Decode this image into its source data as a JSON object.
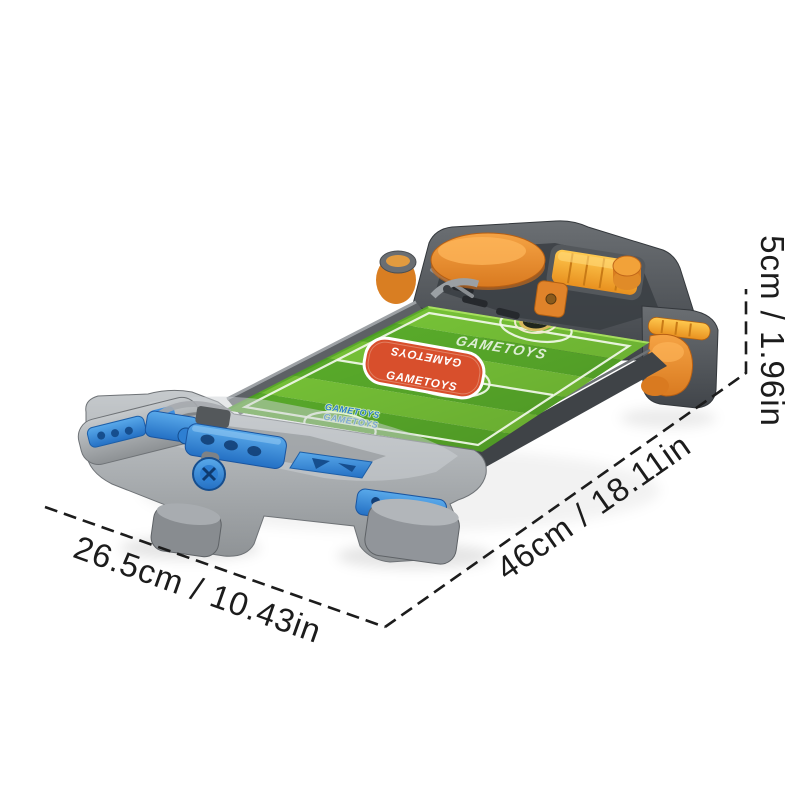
{
  "dimensions": {
    "depth": {
      "label": "26.5cm / 10.43in",
      "cm": 26.5,
      "in": 10.43
    },
    "length": {
      "label": "46cm / 18.11in",
      "cm": 46,
      "in": 18.11
    },
    "height": {
      "label": "5cm / 1.96in",
      "cm": 5,
      "in": 1.96
    }
  },
  "product": {
    "badge": {
      "line1": "GAMETOYS",
      "line2": "GAMETOYS"
    },
    "field_watermark": "GAMETOYS",
    "field_small_text": {
      "line1": "GAMETOYS",
      "line2": "GAMETOYS"
    }
  },
  "colors": {
    "background": "#ffffff",
    "dimension_ink": "#1c1c1c",
    "body_grey_dark": "#4a4e52",
    "body_grey_light": "#9aa0a4",
    "accent_orange": "#e8872f",
    "accent_amber": "#f5b042",
    "accent_blue": "#2e7fd2",
    "field_green_light": "#7bca39",
    "field_green_dark": "#5db32c",
    "badge_red": "#d84f2c",
    "line_white": "#f2f8ea"
  }
}
